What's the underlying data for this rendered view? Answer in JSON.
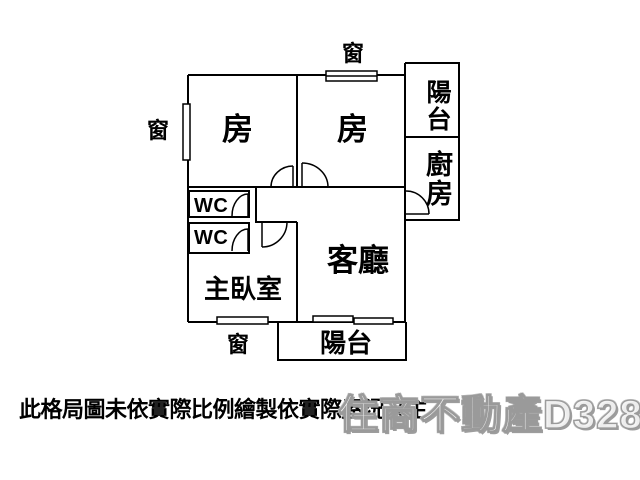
{
  "labels": {
    "window_top": "窗",
    "window_left": "窗",
    "window_bottom": "窗",
    "bedroom_left": "房",
    "bedroom_right": "房",
    "balcony_right": "陽台",
    "kitchen": "廚房",
    "wc_upper": "WC",
    "wc_lower": "WC",
    "master_bedroom": "主臥室",
    "living_room": "客廳",
    "balcony_bottom": "陽台"
  },
  "disclaimer": "此格局圖未依實際比例繪製依實際屋況為主",
  "watermark": "住商不動產D328",
  "colors": {
    "wall": "#000000",
    "background": "#ffffff",
    "watermark_gray": "#9a9a9a"
  }
}
